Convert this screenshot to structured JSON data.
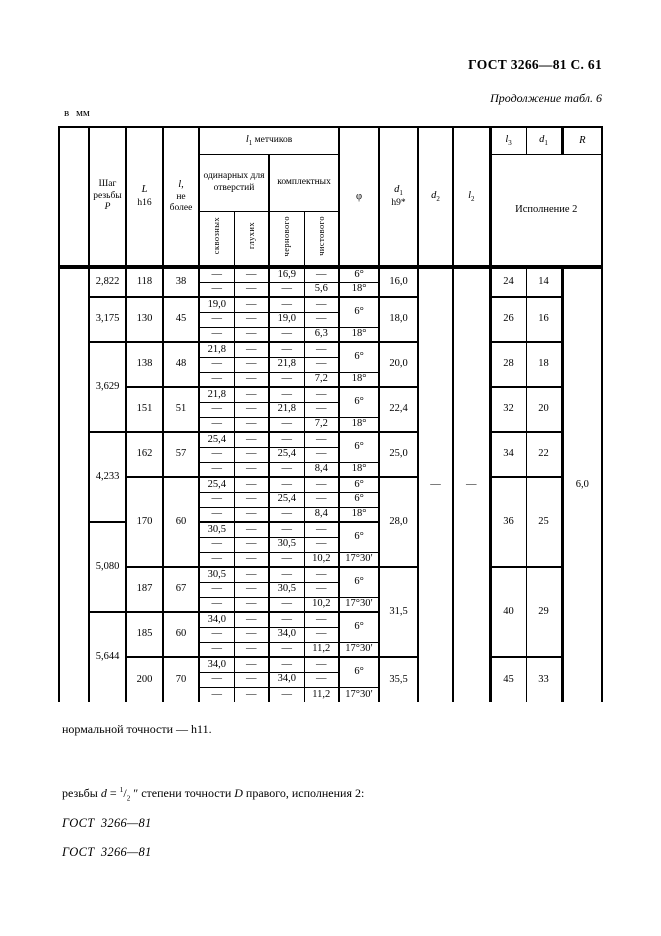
{
  "page": {
    "header_right": "ГОСТ 3266—81 С. 61",
    "continuation": "Продолжение табл. 6",
    "units_label": "в мм"
  },
  "head": {
    "pitch": {
      "line1": "Шаг",
      "line2": "резьбы",
      "sym": "Р"
    },
    "L": {
      "sym": "L",
      "tol": "h16"
    },
    "l": {
      "sym": "l,",
      "line2": "не",
      "line3": "более"
    },
    "l1": {
      "sym": "l",
      "sub": "1",
      "rest": " метчиков"
    },
    "single_group": "одинарных для отверстий",
    "complete_group": "комплектных",
    "through": "сквозных",
    "blind": "глухих",
    "rough": "чернового",
    "finish": "чистового",
    "phi": "φ",
    "d1": {
      "sym": "d",
      "sub": "1",
      "tol": "h9*"
    },
    "d2": {
      "sym": "d",
      "sub": "2"
    },
    "l2": {
      "sym": "l",
      "sub": "2"
    },
    "l3": {
      "sym": "l",
      "sub": "3"
    },
    "d1b": {
      "sym": "d",
      "sub": "1"
    },
    "R": "R",
    "version": "Исполнение 2"
  },
  "table": {
    "spanning": {
      "d2": "—",
      "l2": "—",
      "R": "6,0"
    },
    "rows": [
      {
        "p": "2,822",
        "L": "118",
        "l": "38",
        "c1": "—",
        "c2": "—",
        "c3": "16,9",
        "c4": "—",
        "phi": "6°",
        "d1": "16,0",
        "l3": "24",
        "d1b": "14"
      },
      {
        "c1": "—",
        "c2": "—",
        "c3": "—",
        "c4": "5,6",
        "phi": "18°"
      },
      {
        "p": "3,175",
        "L": "130",
        "l": "45",
        "c1": "19,0",
        "c2": "—",
        "c3": "—",
        "c4": "—",
        "phi": "6°",
        "d1": "18,0",
        "l3": "26",
        "d1b": "16"
      },
      {
        "c1": "—",
        "c2": "—",
        "c3": "19,0",
        "c4": "—"
      },
      {
        "c1": "—",
        "c2": "—",
        "c3": "—",
        "c4": "6,3",
        "phi": "18°"
      },
      {
        "p": "3,629",
        "L": "138",
        "l": "48",
        "c1": "21,8",
        "c2": "—",
        "c3": "—",
        "c4": "—",
        "phi": "6°",
        "d1": "20,0",
        "l3": "28",
        "d1b": "18"
      },
      {
        "c1": "—",
        "c2": "—",
        "c3": "21,8",
        "c4": "—"
      },
      {
        "c1": "—",
        "c2": "—",
        "c3": "—",
        "c4": "7,2",
        "phi": "18°"
      },
      {
        "L": "151",
        "l": "51",
        "c1": "21,8",
        "c2": "—",
        "c3": "—",
        "c4": "—",
        "phi": "6°",
        "d1": "22,4",
        "l3": "32",
        "d1b": "20"
      },
      {
        "c1": "—",
        "c2": "—",
        "c3": "21,8",
        "c4": "—"
      },
      {
        "c1": "—",
        "c2": "—",
        "c3": "—",
        "c4": "7,2",
        "phi": "18°"
      },
      {
        "p": "4,233",
        "L": "162",
        "l": "57",
        "c1": "25,4",
        "c2": "—",
        "c3": "—",
        "c4": "—",
        "phi": "6°",
        "d1": "25,0",
        "l3": "34",
        "d1b": "22"
      },
      {
        "c1": "—",
        "c2": "—",
        "c3": "25,4",
        "c4": "—"
      },
      {
        "c1": "—",
        "c2": "—",
        "c3": "—",
        "c4": "8,4",
        "phi": "18°"
      },
      {
        "L": "170",
        "l": "60",
        "c1": "25,4",
        "c2": "—",
        "c3": "—",
        "c4": "—",
        "phi": "6°",
        "d1": "28,0",
        "l3": "36",
        "d1b": "25"
      },
      {
        "c1": "—",
        "c2": "—",
        "c3": "25,4",
        "c4": "—",
        "phi": "6°"
      },
      {
        "c1": "—",
        "c2": "—",
        "c3": "—",
        "c4": "8,4",
        "phi": "18°"
      },
      {
        "p": "5,080",
        "c1": "30,5",
        "c2": "—",
        "c3": "—",
        "c4": "—",
        "phi": "6°"
      },
      {
        "c1": "—",
        "c2": "—",
        "c3": "30,5",
        "c4": "—"
      },
      {
        "c1": "—",
        "c2": "—",
        "c3": "—",
        "c4": "10,2",
        "phi": "17°30′"
      },
      {
        "L": "187",
        "l": "67",
        "c1": "30,5",
        "c2": "—",
        "c3": "—",
        "c4": "—",
        "phi": "6°",
        "d1": "31,5",
        "l3": "40",
        "d1b": "29"
      },
      {
        "c1": "—",
        "c2": "—",
        "c3": "30,5",
        "c4": "—"
      },
      {
        "c1": "—",
        "c2": "—",
        "c3": "—",
        "c4": "10,2",
        "phi": "17°30′"
      },
      {
        "p": "5,644",
        "L": "185",
        "l": "60",
        "c1": "34,0",
        "c2": "—",
        "c3": "—",
        "c4": "—",
        "phi": "6°"
      },
      {
        "c1": "—",
        "c2": "—",
        "c3": "34,0",
        "c4": "—"
      },
      {
        "c1": "—",
        "c2": "—",
        "c3": "—",
        "c4": "11,2",
        "phi": "17°30′"
      },
      {
        "L": "200",
        "l": "70",
        "c1": "34,0",
        "c2": "—",
        "c3": "—",
        "c4": "—",
        "phi": "6°",
        "d1": "35,5",
        "l3": "45",
        "d1b": "33"
      },
      {
        "c1": "—",
        "c2": "—",
        "c3": "34,0",
        "c4": "—"
      },
      {
        "c1": "—",
        "c2": "—",
        "c3": "—",
        "c4": "11,2",
        "phi": "17°30′"
      }
    ]
  },
  "footer": {
    "note1": "нормальной точности — h11.",
    "note2": {
      "pre": "резьбы ",
      "sym": "d",
      "eq": " = ",
      "num": "1",
      "slash": "/",
      "den": "2",
      "inch": " ″",
      "mid": " степени точности  ",
      "sym2": "D",
      "post": " правого, исполнения 2:"
    },
    "gost1": "ГОСТ 3266—81",
    "gost2": "ГОСТ 3266—81"
  }
}
